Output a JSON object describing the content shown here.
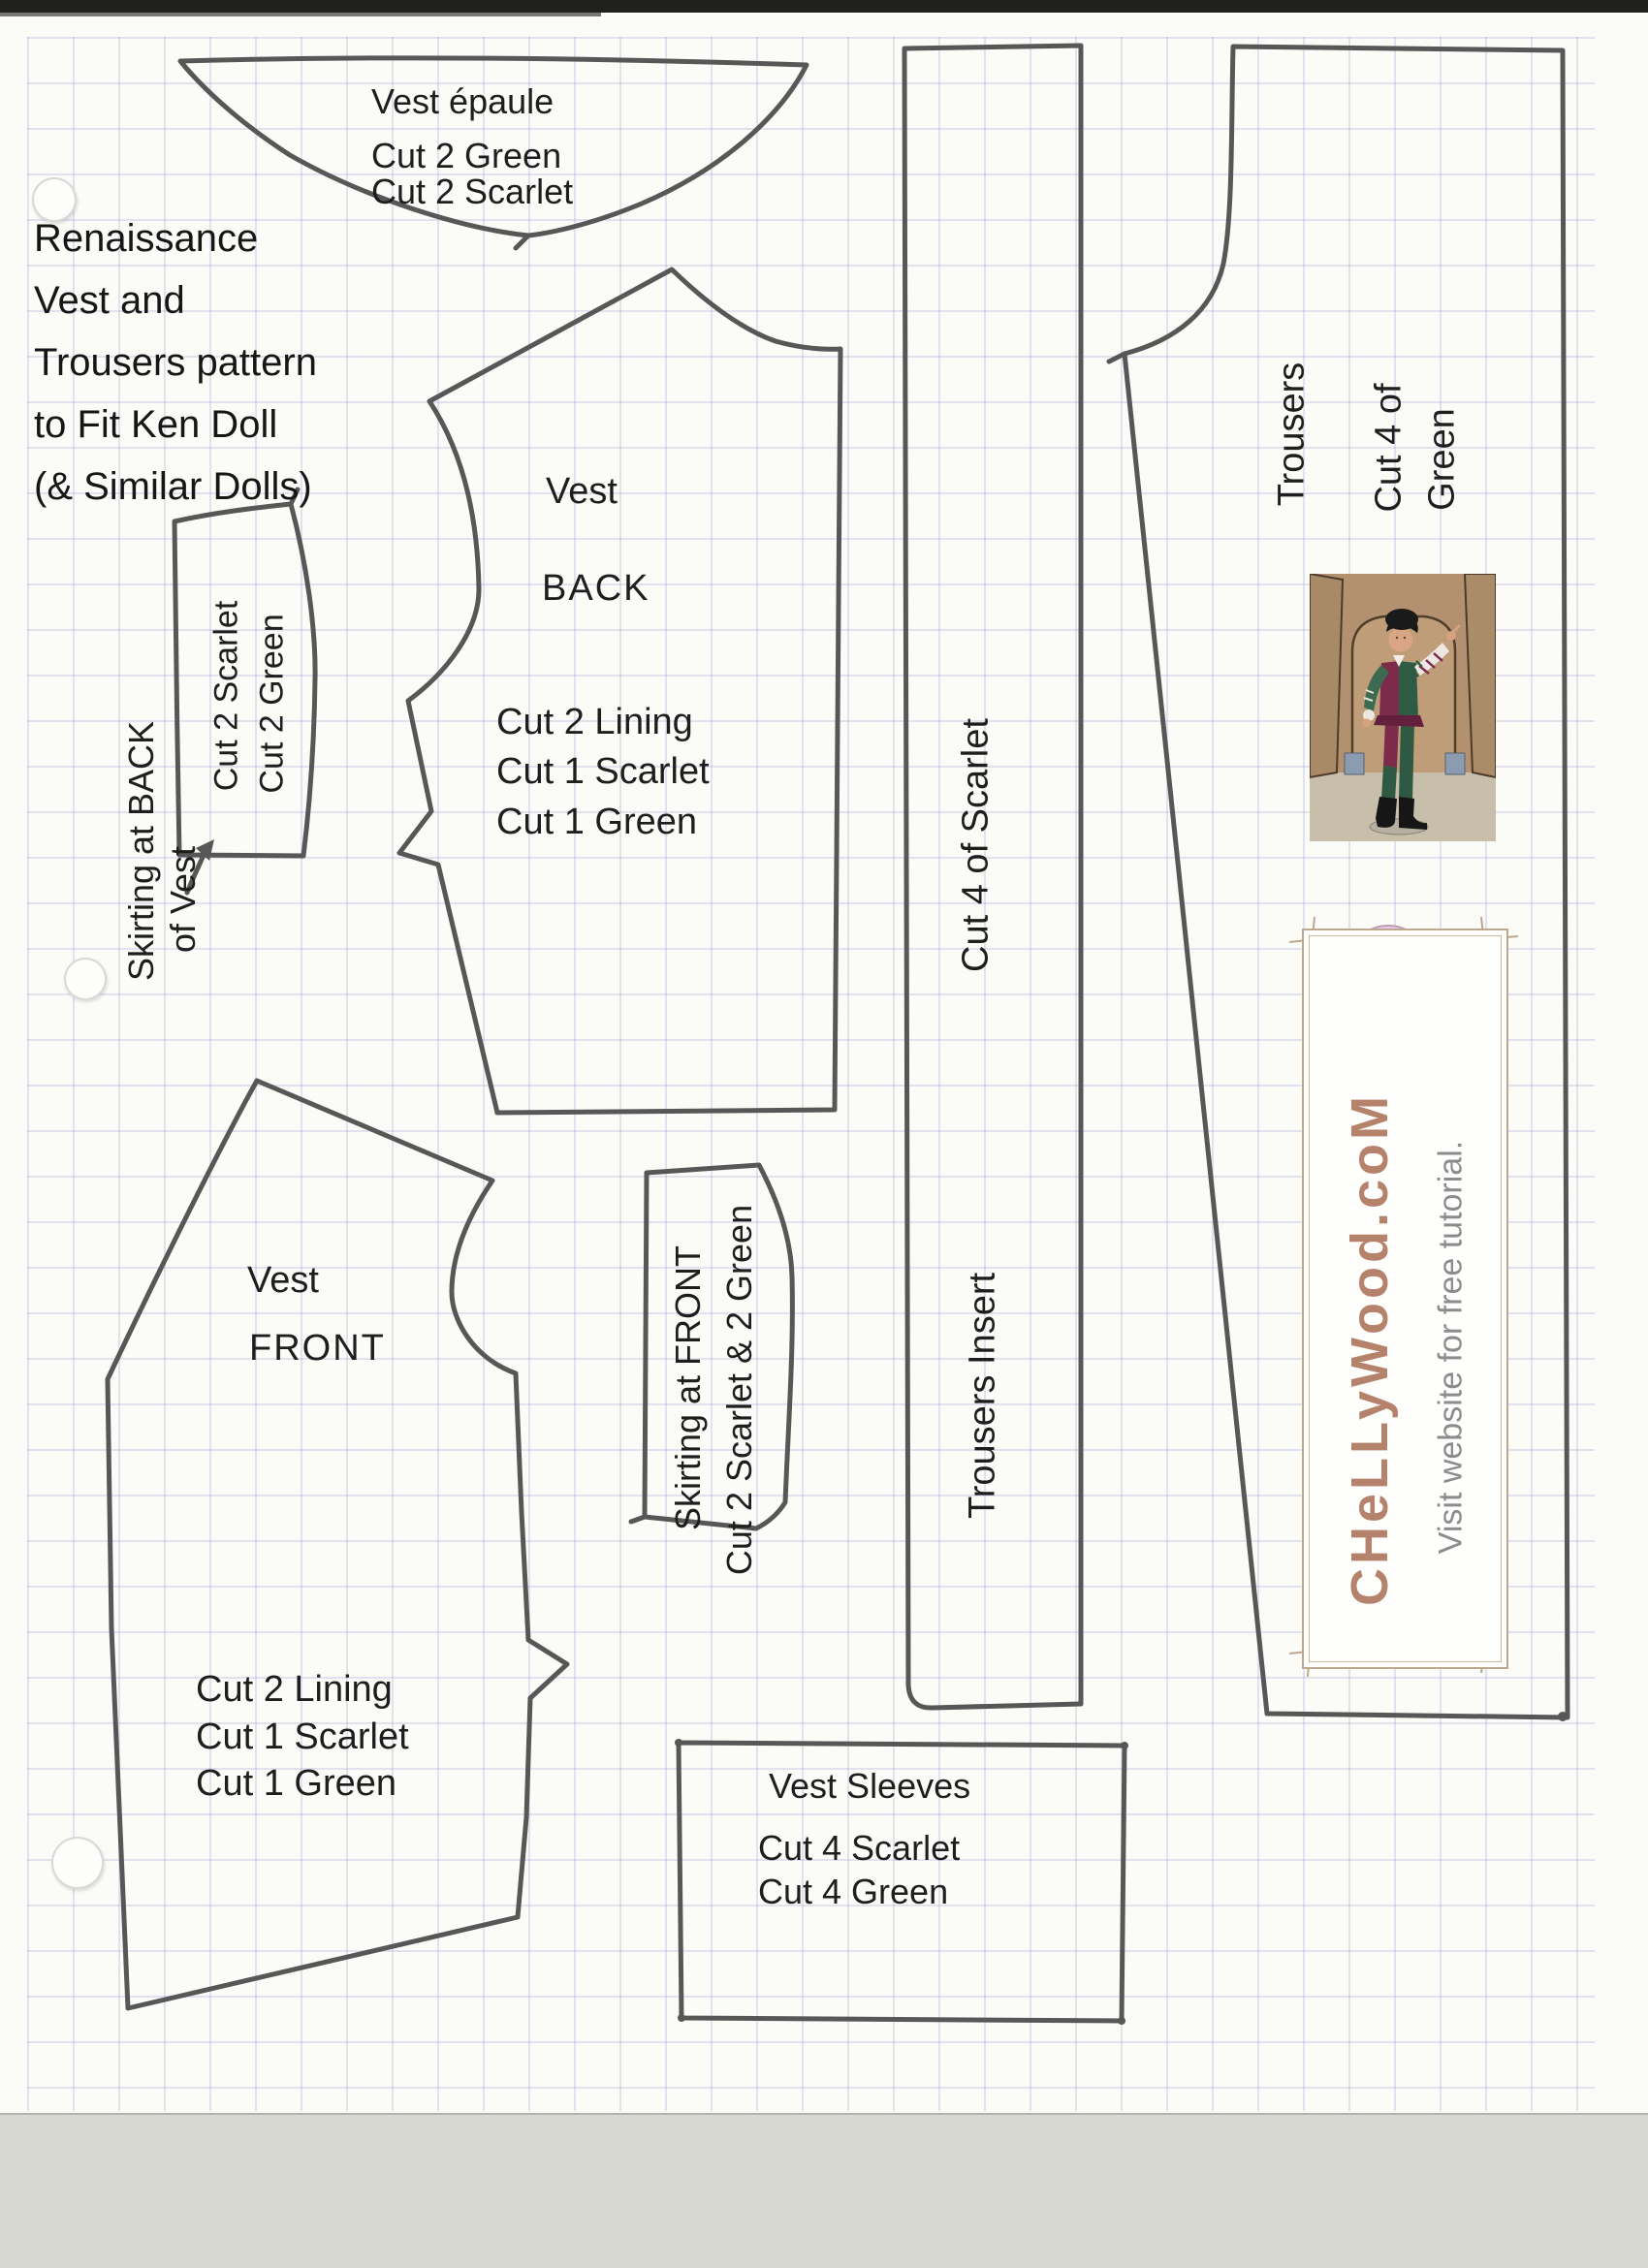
{
  "document": {
    "title_lines": [
      "Renaissance",
      "Vest and",
      "Trousers pattern",
      "to Fit Ken Doll",
      "(& Similar Dolls)"
    ]
  },
  "pieces": {
    "vest_epaule": {
      "name": "Vest épaule",
      "cut_line1": "Cut 2 Green",
      "cut_line2": "Cut 2 Scarlet"
    },
    "skirting_back": {
      "label_line1": "Skirting at BACK",
      "label_line2": "of Vest",
      "cut_line1": "Cut 2 Scarlet",
      "cut_line2": "Cut 2 Green"
    },
    "vest_back": {
      "name_line1": "Vest",
      "name_line2": "BACK",
      "cut_lines": [
        "Cut 2 Lining",
        "Cut 1 Scarlet",
        "Cut 1 Green"
      ]
    },
    "vest_front": {
      "name_line1": "Vest",
      "name_line2": "FRONT",
      "cut_lines": [
        "Cut 2 Lining",
        "Cut 1 Scarlet",
        "Cut 1 Green"
      ]
    },
    "skirting_front": {
      "label": "Skirting at FRONT",
      "cut_label": "Cut 2 Scarlet & 2 Green"
    },
    "trousers_insert": {
      "name": "Trousers Insert",
      "cut_label": "Cut 4 of Scarlet"
    },
    "trousers": {
      "name": "Trousers",
      "cut_line1": "Cut 4 of",
      "cut_line2": "Green"
    },
    "vest_sleeves": {
      "name": "Vest Sleeves",
      "cut_line1": "Cut 4 Scarlet",
      "cut_line2": "Cut 4 Green"
    }
  },
  "logo": {
    "brand": "CHeLLyWood.coM",
    "tagline": "Visit website for free tutorial."
  },
  "colors": {
    "pencil": "#575757",
    "accent_brown": "#b5826b",
    "flower_pink": "#ecc9ec",
    "tagline_gray": "#8c8c8c",
    "vest_maroon": "#7c2b4a",
    "vest_green": "#2f5a43"
  }
}
